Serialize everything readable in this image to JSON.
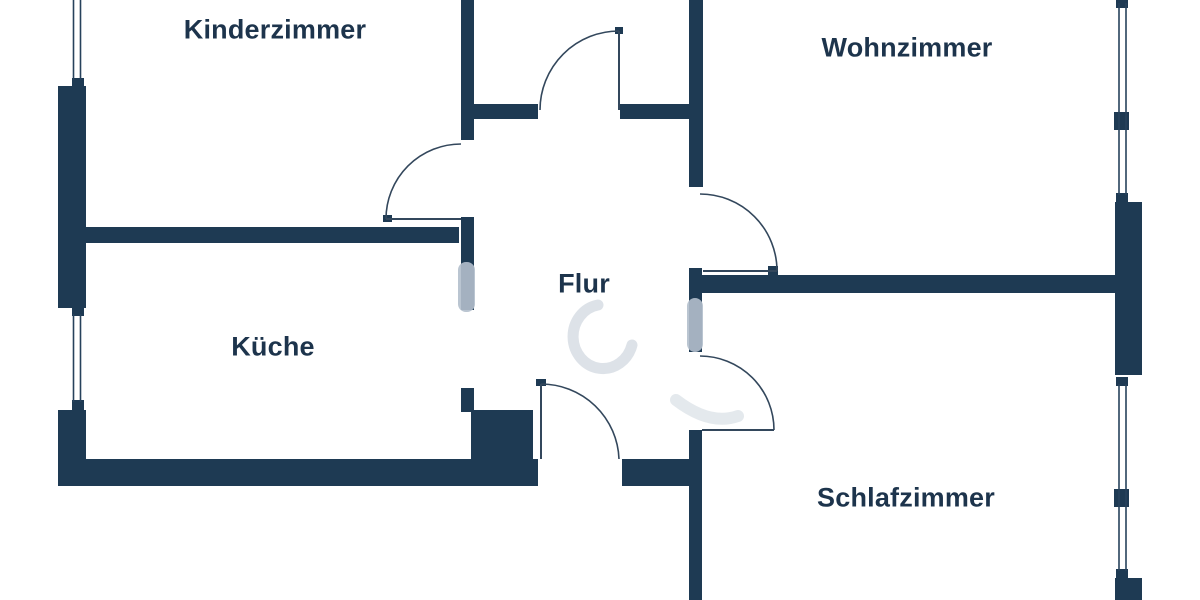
{
  "meta": {
    "title": "apartment-floorplan",
    "background": "#ffffff"
  },
  "palette": {
    "wall": "#1e3a53",
    "door_line": "#33475c",
    "window_line": "#27425c",
    "label": "#1d344c",
    "watermark": "#b3bfcc"
  },
  "rooms": [
    {
      "id": "kinderzimmer",
      "label": "Kinderzimmer",
      "cx": 275,
      "cy": 30
    },
    {
      "id": "wohnzimmer",
      "label": "Wohnzimmer",
      "cx": 907,
      "cy": 48
    },
    {
      "id": "kueche",
      "label": "Küche",
      "cx": 273,
      "cy": 347
    },
    {
      "id": "flur",
      "label": "Flur",
      "cx": 584,
      "cy": 284
    },
    {
      "id": "schlafzimmer",
      "label": "Schlafzimmer",
      "cx": 906,
      "cy": 498
    }
  ],
  "walls": [
    {
      "x": 58,
      "y": 86,
      "w": 28,
      "h": 222
    },
    {
      "x": 58,
      "y": 410,
      "w": 28,
      "h": 76
    },
    {
      "x": 58,
      "y": 459,
      "w": 480,
      "h": 27
    },
    {
      "x": 622,
      "y": 459,
      "w": 80,
      "h": 27
    },
    {
      "x": 78,
      "y": 227,
      "w": 381,
      "h": 16
    },
    {
      "x": 461,
      "y": 0,
      "w": 13,
      "h": 140
    },
    {
      "x": 461,
      "y": 217,
      "w": 13,
      "h": 93
    },
    {
      "x": 461,
      "y": 388,
      "w": 13,
      "h": 24
    },
    {
      "x": 471,
      "y": 410,
      "w": 62,
      "h": 50
    },
    {
      "x": 474,
      "y": 104,
      "w": 64,
      "h": 15
    },
    {
      "x": 620,
      "y": 104,
      "w": 69,
      "h": 15
    },
    {
      "x": 689,
      "y": 0,
      "w": 14,
      "h": 187
    },
    {
      "x": 689,
      "y": 268,
      "w": 13,
      "h": 84
    },
    {
      "x": 700,
      "y": 275,
      "w": 415,
      "h": 18
    },
    {
      "x": 689,
      "y": 430,
      "w": 13,
      "h": 170
    },
    {
      "x": 1115,
      "y": 202,
      "w": 27,
      "h": 173
    },
    {
      "x": 1115,
      "y": 578,
      "w": 27,
      "h": 22
    },
    {
      "x": 72,
      "y": 78,
      "w": 12,
      "h": 10
    },
    {
      "x": 72,
      "y": 306,
      "w": 12,
      "h": 10
    },
    {
      "x": 72,
      "y": 400,
      "w": 12,
      "h": 10
    },
    {
      "x": 1116,
      "y": 0,
      "w": 12,
      "h": 8
    },
    {
      "x": 1114,
      "y": 112,
      "w": 15,
      "h": 18
    },
    {
      "x": 1116,
      "y": 193,
      "w": 12,
      "h": 9
    },
    {
      "x": 1116,
      "y": 377,
      "w": 12,
      "h": 9
    },
    {
      "x": 1114,
      "y": 489,
      "w": 15,
      "h": 18
    },
    {
      "x": 1116,
      "y": 569,
      "w": 12,
      "h": 9
    },
    {
      "x": 383,
      "y": 215,
      "w": 9,
      "h": 7
    },
    {
      "x": 615,
      "y": 27,
      "w": 8,
      "h": 7
    },
    {
      "x": 536,
      "y": 379,
      "w": 10,
      "h": 7
    },
    {
      "x": 768,
      "y": 266,
      "w": 10,
      "h": 9
    }
  ],
  "windows": [
    {
      "x1": 73.5,
      "y1": 0,
      "x2": 73.5,
      "y2": 80
    },
    {
      "x1": 80.5,
      "y1": 0,
      "x2": 80.5,
      "y2": 80
    },
    {
      "x1": 73.5,
      "y1": 314,
      "x2": 73.5,
      "y2": 402
    },
    {
      "x1": 80.5,
      "y1": 314,
      "x2": 80.5,
      "y2": 402
    },
    {
      "x1": 1119,
      "y1": 3,
      "x2": 1119,
      "y2": 195
    },
    {
      "x1": 1126,
      "y1": 3,
      "x2": 1126,
      "y2": 195
    },
    {
      "x1": 1119,
      "y1": 384,
      "x2": 1119,
      "y2": 571
    },
    {
      "x1": 1126,
      "y1": 384,
      "x2": 1126,
      "y2": 571
    }
  ],
  "doors": [
    {
      "name": "kinderzimmer-door",
      "leaf": {
        "x1": 386,
        "y1": 219,
        "x2": 461,
        "y2": 219
      },
      "arc": "M386,219 A75,75 0 0 1 461,144"
    },
    {
      "name": "bath-door",
      "leaf": {
        "x1": 619,
        "y1": 31,
        "x2": 619,
        "y2": 110
      },
      "arc": "M540,110 A79,79 0 0 1 619,31"
    },
    {
      "name": "wohnzimmer-door",
      "leaf": {
        "x1": 703,
        "y1": 271,
        "x2": 777,
        "y2": 271
      },
      "arc": "M700,194 A77,77 0 0 1 777,271"
    },
    {
      "name": "schlafzimmer-door",
      "leaf": {
        "x1": 702,
        "y1": 430,
        "x2": 774,
        "y2": 430
      },
      "arc": "M700,356 A74,74 0 0 1 774,430"
    },
    {
      "name": "entrance-door",
      "leaf": {
        "x1": 541,
        "y1": 384,
        "x2": 541,
        "y2": 459
      },
      "arc": "M541,384 A78,78 0 0 1 619,459"
    }
  ],
  "watermark": {
    "patches": [
      {
        "x": 458,
        "y": 262,
        "w": 17,
        "h": 50,
        "r": 8,
        "opacity": 0.9
      },
      {
        "x": 687,
        "y": 298,
        "w": 16,
        "h": 54,
        "r": 8,
        "opacity": 0.9
      }
    ],
    "strokes": [
      {
        "d": "M598,305 a30,32 0 1 0 34,40",
        "w": 11,
        "opacity": 0.45
      },
      {
        "d": "M676,400 q34,26 62,16",
        "w": 12,
        "opacity": 0.35
      }
    ]
  }
}
